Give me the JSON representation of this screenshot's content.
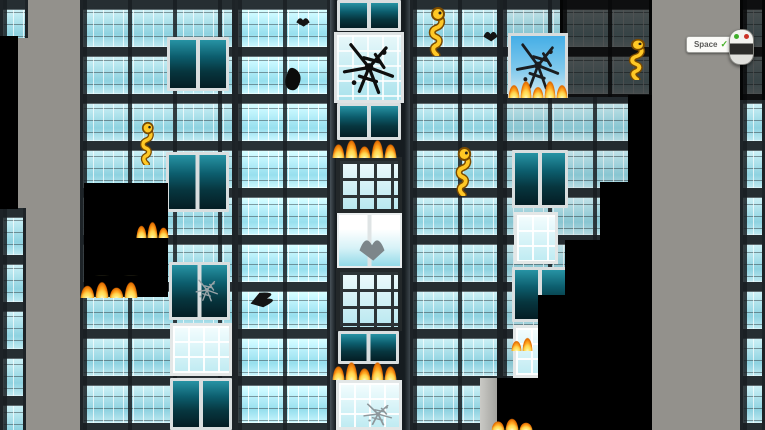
{
  "hud": {
    "key_button": {
      "label": "Space",
      "status_glyph": "✓",
      "check_color": "#49b32b"
    },
    "mouse_indicator": {
      "left_button_color": "#3fae2a",
      "right_button_color": "#cc3326"
    }
  },
  "colors": {
    "fire_core": "#ffd24e",
    "fire_edge": "#e06a00",
    "glass_light": "#c6eef4",
    "glass_dark_teal": "#0c5d6d",
    "burned_black": "#000000",
    "sky_gray": "#93918c",
    "creature_yellow": "#ffc825"
  },
  "scene": {
    "buildings": [
      {
        "name": "building-left-sliver-top",
        "x": 0,
        "y": 0,
        "w": 28,
        "h": 38,
        "variant": ""
      },
      {
        "name": "building-left-sliver-bottom",
        "x": 0,
        "y": 208,
        "w": 26,
        "h": 222,
        "variant": ""
      },
      {
        "name": "building-west",
        "x": 80,
        "y": 0,
        "w": 155,
        "h": 430,
        "variant": ""
      },
      {
        "name": "building-midwest",
        "x": 235,
        "y": 0,
        "w": 95,
        "h": 430,
        "variant": "bright"
      },
      {
        "name": "tower-center",
        "x": 330,
        "y": 0,
        "w": 80,
        "h": 430,
        "variant": "tower"
      },
      {
        "name": "building-mideast",
        "x": 410,
        "y": 0,
        "w": 90,
        "h": 430,
        "variant": ""
      },
      {
        "name": "building-east",
        "x": 500,
        "y": 0,
        "w": 152,
        "h": 430,
        "variant": "dim"
      },
      {
        "name": "building-east-dark-top",
        "x": 560,
        "y": 0,
        "w": 92,
        "h": 97,
        "variant": "dark"
      },
      {
        "name": "building-far-right",
        "x": 740,
        "y": 0,
        "w": 25,
        "h": 430,
        "variant": ""
      },
      {
        "name": "building-far-right-dark-top",
        "x": 740,
        "y": 0,
        "w": 25,
        "h": 100,
        "variant": "dark"
      }
    ],
    "features": [
      {
        "type": "dark-pair",
        "x": 167,
        "y": 37,
        "w": 62,
        "h": 54
      },
      {
        "type": "dark-pair",
        "x": 166,
        "y": 152,
        "w": 63,
        "h": 60
      },
      {
        "type": "dark-pair",
        "x": 169,
        "y": 262,
        "w": 61,
        "h": 58
      },
      {
        "type": "grid-window",
        "x": 170,
        "y": 323,
        "w": 62,
        "h": 53
      },
      {
        "type": "dark-pair",
        "x": 170,
        "y": 378,
        "w": 62,
        "h": 52
      },
      {
        "type": "dark-pair",
        "x": 337,
        "y": 0,
        "w": 64,
        "h": 31
      },
      {
        "type": "shattered-window",
        "x": 334,
        "y": 32,
        "w": 70,
        "h": 71
      },
      {
        "type": "dark-pair",
        "x": 337,
        "y": 103,
        "w": 64,
        "h": 37
      },
      {
        "type": "grid-window-dark",
        "x": 336,
        "y": 157,
        "w": 66,
        "h": 56
      },
      {
        "type": "white-pair",
        "x": 337,
        "y": 213,
        "w": 65,
        "h": 55
      },
      {
        "type": "grid-window-dark",
        "x": 336,
        "y": 268,
        "w": 66,
        "h": 63
      },
      {
        "type": "dark-pair",
        "x": 338,
        "y": 331,
        "w": 61,
        "h": 33
      },
      {
        "type": "grid-window",
        "x": 336,
        "y": 380,
        "w": 66,
        "h": 50
      },
      {
        "type": "sky-window",
        "x": 508,
        "y": 33,
        "w": 60,
        "h": 65
      },
      {
        "type": "dark-pair",
        "x": 512,
        "y": 150,
        "w": 56,
        "h": 58
      },
      {
        "type": "grid-window",
        "x": 514,
        "y": 212,
        "w": 44,
        "h": 52
      },
      {
        "type": "dark-pair",
        "x": 512,
        "y": 267,
        "w": 56,
        "h": 55
      },
      {
        "type": "grid-window",
        "x": 513,
        "y": 325,
        "w": 28,
        "h": 53
      },
      {
        "type": "pillar",
        "x": 480,
        "y": 378,
        "w": 17,
        "h": 52
      }
    ],
    "cutouts": [
      {
        "x": 0,
        "y": 36,
        "w": 18,
        "h": 173
      },
      {
        "x": 84,
        "y": 183,
        "w": 84,
        "h": 114
      },
      {
        "x": 628,
        "y": 95,
        "w": 24,
        "h": 88
      },
      {
        "x": 600,
        "y": 182,
        "w": 52,
        "h": 59
      },
      {
        "x": 565,
        "y": 240,
        "w": 87,
        "h": 56
      },
      {
        "x": 538,
        "y": 295,
        "w": 114,
        "h": 135
      },
      {
        "x": 497,
        "y": 378,
        "w": 45,
        "h": 52
      }
    ],
    "fires": [
      {
        "x": 136,
        "y": 221,
        "w": 33,
        "h": 17
      },
      {
        "x": 80,
        "y": 281,
        "w": 58,
        "h": 17
      },
      {
        "x": 332,
        "y": 139,
        "w": 65,
        "h": 19
      },
      {
        "x": 332,
        "y": 361,
        "w": 65,
        "h": 19
      },
      {
        "x": 508,
        "y": 80,
        "w": 60,
        "h": 18
      },
      {
        "x": 511,
        "y": 337,
        "w": 22,
        "h": 14
      },
      {
        "x": 491,
        "y": 418,
        "w": 42,
        "h": 12
      }
    ],
    "sprites": [
      {
        "type": "creature",
        "x": 424,
        "y": 6,
        "w": 26,
        "h": 50
      },
      {
        "type": "creature",
        "x": 451,
        "y": 146,
        "w": 25,
        "h": 50
      },
      {
        "type": "creature",
        "x": 136,
        "y": 121,
        "w": 22,
        "h": 44
      },
      {
        "type": "creature",
        "x": 624,
        "y": 38,
        "w": 26,
        "h": 42
      },
      {
        "type": "bird",
        "x": 482,
        "y": 27,
        "w": 17,
        "h": 16
      },
      {
        "type": "bird",
        "x": 295,
        "y": 14,
        "w": 16,
        "h": 14
      },
      {
        "type": "bird",
        "x": 256,
        "y": 280,
        "w": 18,
        "h": 38,
        "rot": 75
      },
      {
        "type": "blob",
        "x": 283,
        "y": 66,
        "w": 20,
        "h": 26
      },
      {
        "type": "decal",
        "x": 193,
        "y": 276,
        "w": 28,
        "h": 28,
        "color": "#9aa4a8"
      },
      {
        "type": "bird",
        "x": 357,
        "y": 230,
        "w": 30,
        "h": 34,
        "color": "#7d868a"
      },
      {
        "type": "decal",
        "x": 360,
        "y": 400,
        "w": 36,
        "h": 28,
        "color": "#8d979b"
      }
    ]
  }
}
